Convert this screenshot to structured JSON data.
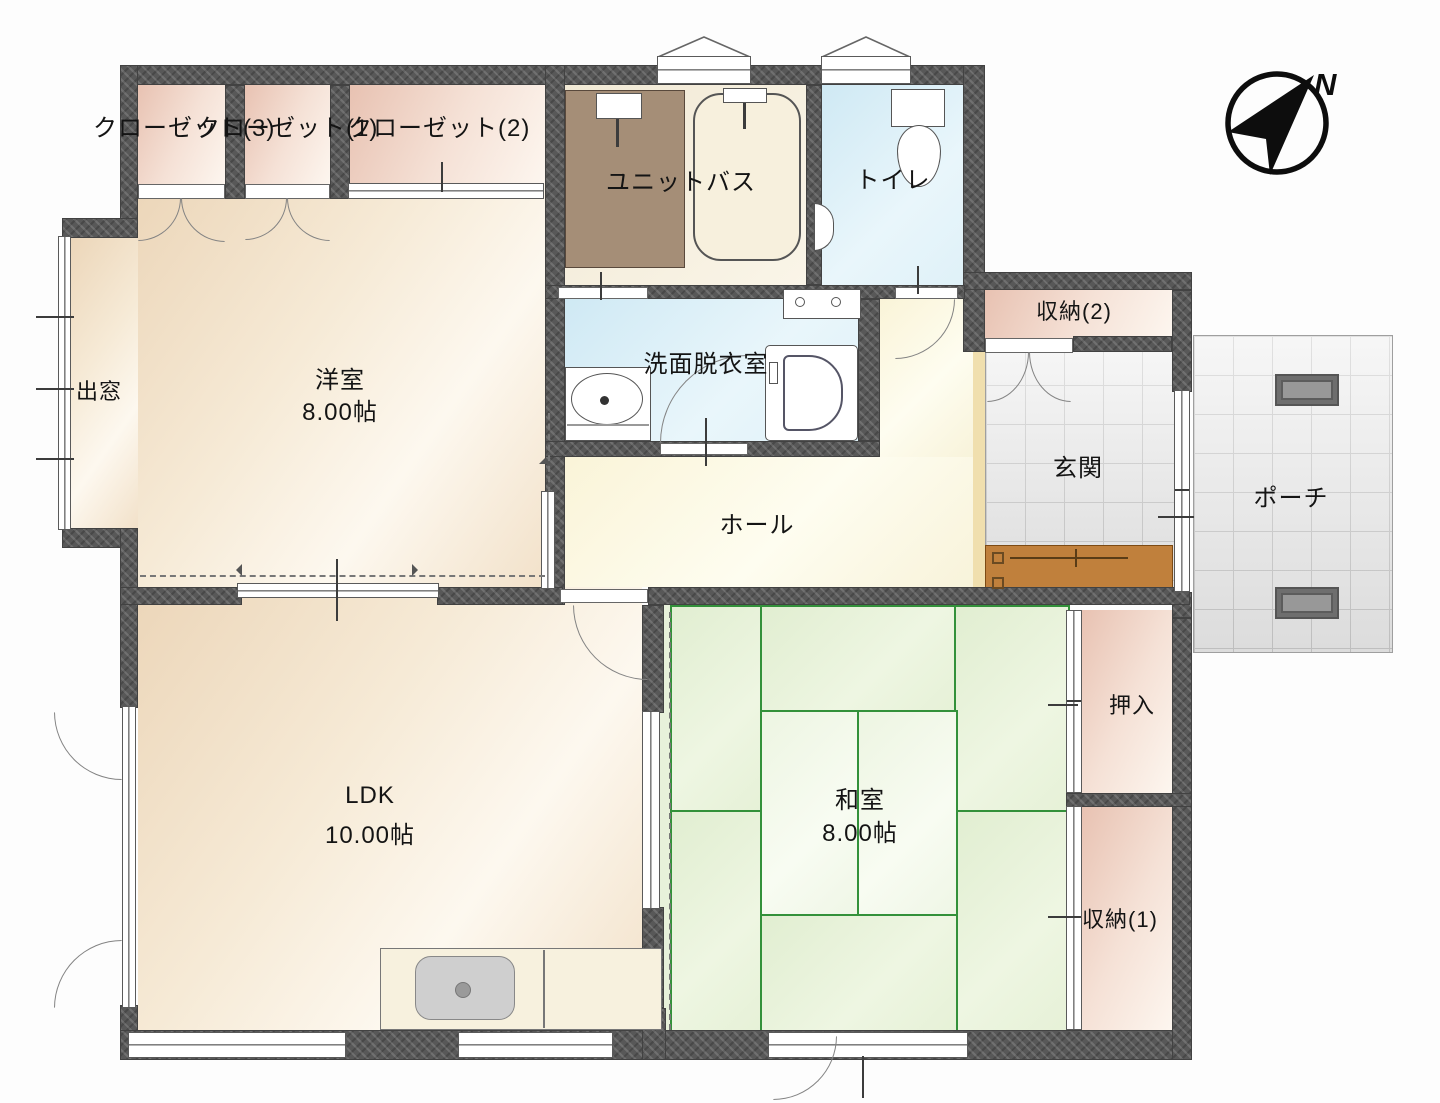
{
  "title": "floor-plan",
  "rooms": {
    "closet3": {
      "label": "クローゼット(3)"
    },
    "closet1": {
      "label": "クローゼット(1)"
    },
    "closet2": {
      "label": "クローゼット(2)"
    },
    "bay_window": {
      "label": "出窓"
    },
    "western_room": {
      "label": "洋室",
      "size": "8.00帖"
    },
    "unit_bath": {
      "label": "ユニットバス"
    },
    "toilet": {
      "label": "トイレ"
    },
    "washroom": {
      "label": "洗面脱衣室"
    },
    "hall": {
      "label": "ホール"
    },
    "storage2": {
      "label": "収納(2)"
    },
    "entrance": {
      "label": "玄関"
    },
    "porch": {
      "label": "ポーチ"
    },
    "ldk": {
      "label": "LDK",
      "size": "10.00帖"
    },
    "japanese_room": {
      "label": "和室",
      "size": "8.00帖"
    },
    "oshiire": {
      "label": "押入"
    },
    "storage1": {
      "label": "収納(1)"
    }
  },
  "compass": {
    "north_label": "N"
  },
  "palette": {
    "wall": "#585858",
    "tatami_line": "#33913a",
    "floor_wood": "#f2e2cb",
    "floor_closet": "#f2d9cb",
    "floor_wet": "#ddeef7",
    "floor_hall": "#fbf7e2",
    "tile_gray": "#ececec",
    "entrance_step_brown": "#c0803c",
    "bath_floor_brown": "#a58e77"
  }
}
